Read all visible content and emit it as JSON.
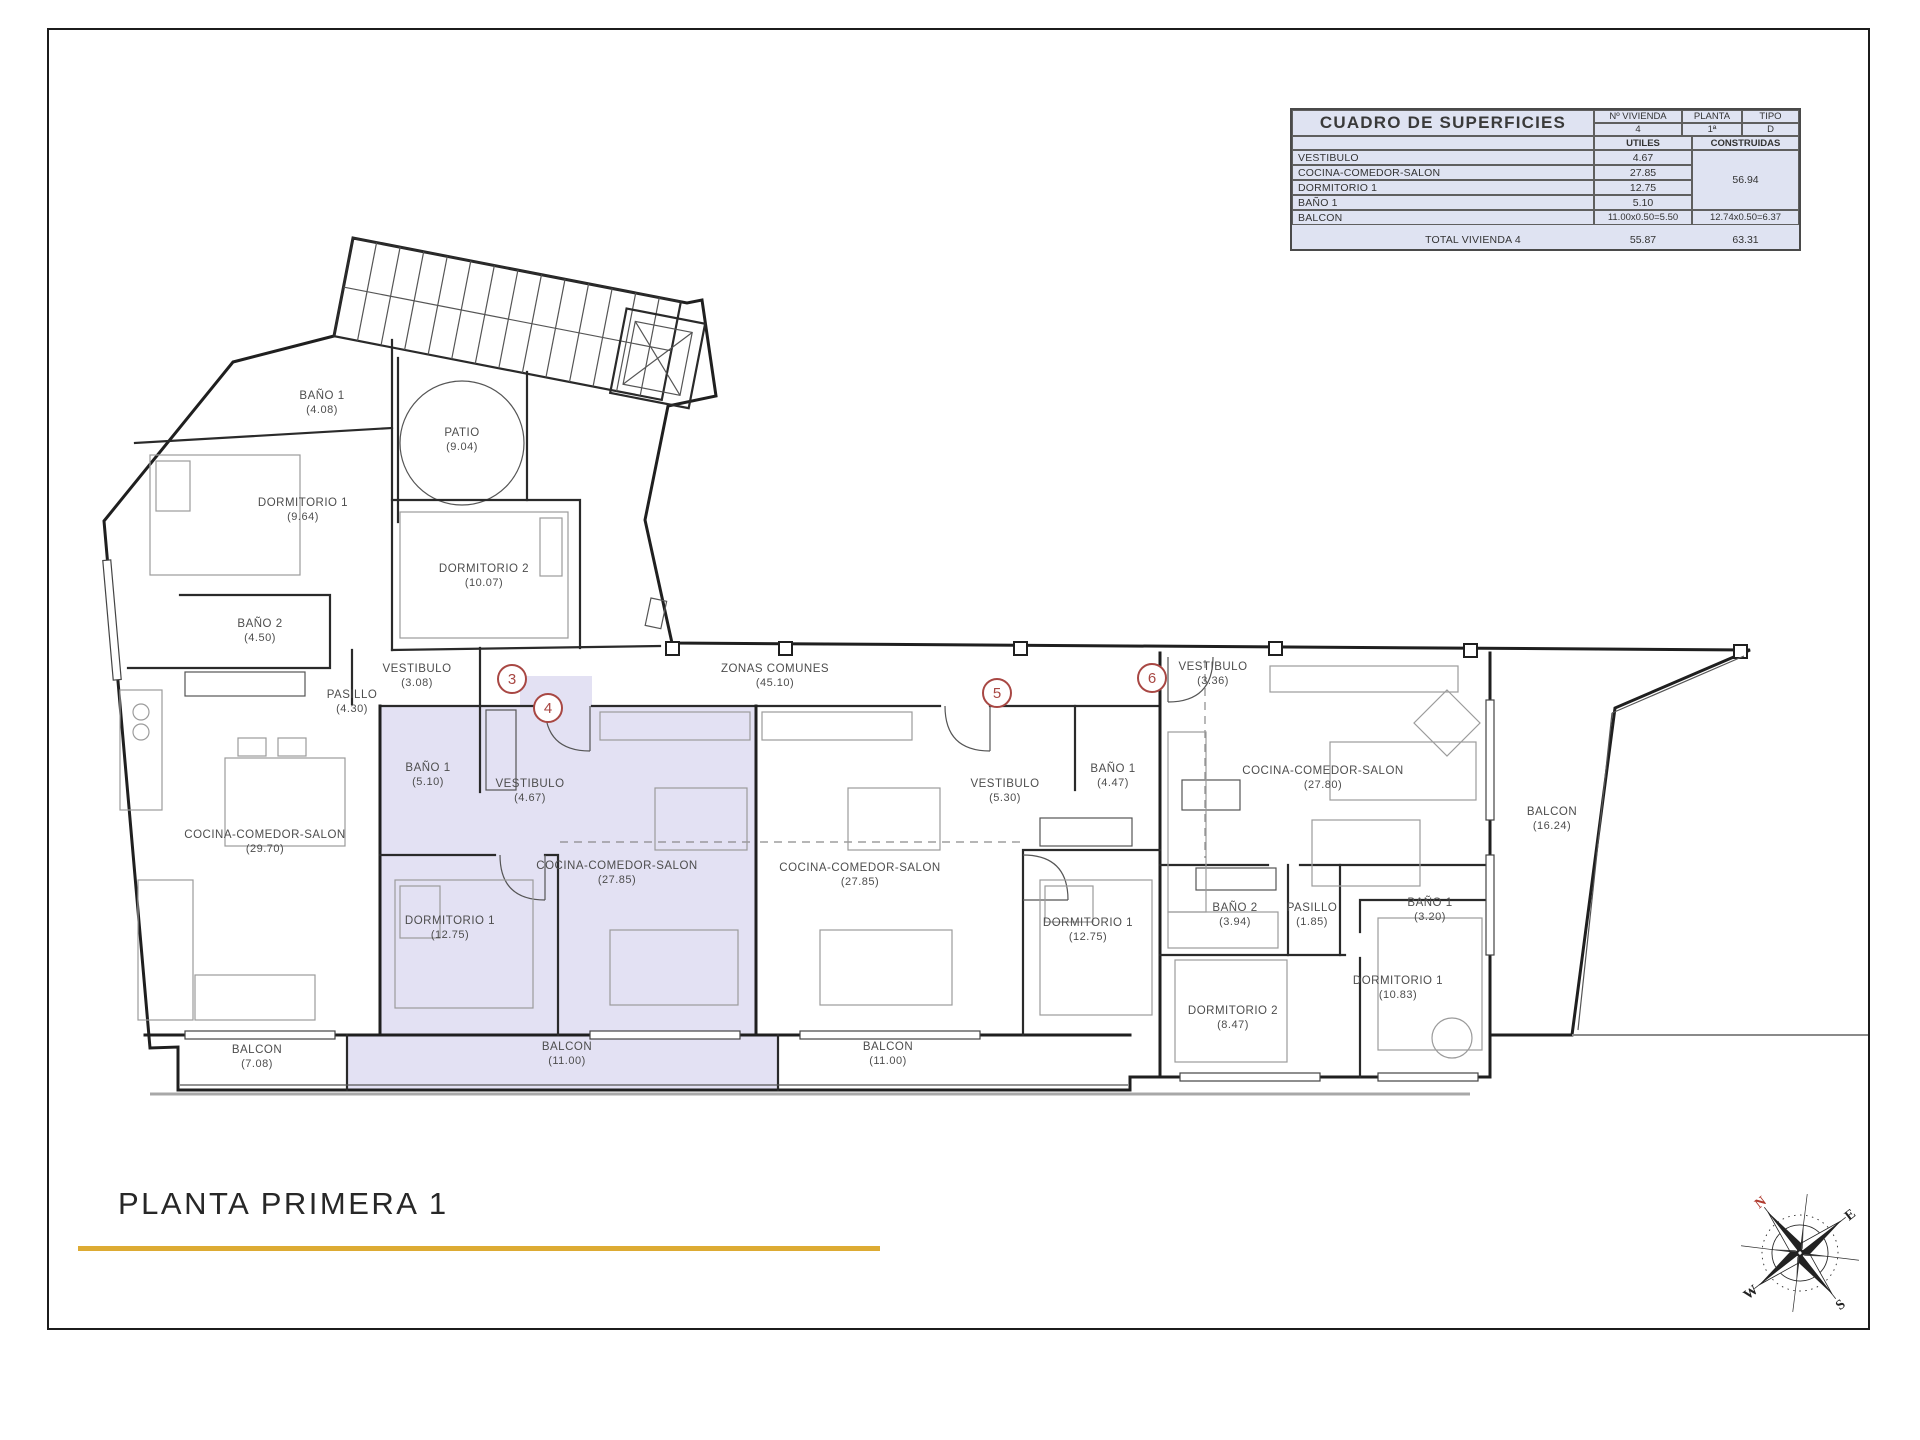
{
  "table": {
    "title": "CUADRO DE SUPERFICIES",
    "col_vivienda": "Nº VIVIENDA",
    "col_planta": "PLANTA",
    "col_tipo": "TIPO",
    "vivienda": "4",
    "planta": "1ª",
    "tipo": "D",
    "utiles_label": "UTILES",
    "construidas_label": "CONSTRUIDAS",
    "rows": [
      {
        "name": "VESTIBULO",
        "utiles": "4.67"
      },
      {
        "name": "COCINA-COMEDOR-SALON",
        "utiles": "27.85"
      },
      {
        "name": "DORMITORIO 1",
        "utiles": "12.75"
      },
      {
        "name": "BAÑO 1",
        "utiles": "5.10"
      }
    ],
    "construidas_merged": "56.94",
    "balcon_row": {
      "name": "BALCON",
      "utiles": "11.00x0.50=5.50",
      "construidas": "12.74x0.50=6.37"
    },
    "total_label": "TOTAL VIVIENDA 4",
    "total_utiles": "55.87",
    "total_construidas": "63.31"
  },
  "plan": {
    "units": [
      {
        "number": "3"
      },
      {
        "number": "4"
      },
      {
        "number": "5"
      },
      {
        "number": "6"
      }
    ],
    "rooms": [
      {
        "name": "BAÑO 1",
        "area": "(4.08)"
      },
      {
        "name": "PATIO",
        "area": "(9.04)"
      },
      {
        "name": "DORMITORIO 1",
        "area": "(9.64)"
      },
      {
        "name": "DORMITORIO 2",
        "area": "(10.07)"
      },
      {
        "name": "BAÑO 2",
        "area": "(4.50)"
      },
      {
        "name": "VESTIBULO",
        "area": "(3.08)"
      },
      {
        "name": "PASILLO",
        "area": "(4.30)"
      },
      {
        "name": "COCINA-COMEDOR-SALON",
        "area": "(29.70)"
      },
      {
        "name": "BALCON",
        "area": "(7.08)"
      },
      {
        "name": "ZONAS COMUNES",
        "area": "(45.10)"
      },
      {
        "name": "BAÑO 1",
        "area": "(5.10)"
      },
      {
        "name": "VESTIBULO",
        "area": "(4.67)"
      },
      {
        "name": "COCINA-COMEDOR-SALON",
        "area": "(27.85)"
      },
      {
        "name": "DORMITORIO 1",
        "area": "(12.75)"
      },
      {
        "name": "BALCON",
        "area": "(11.00)"
      },
      {
        "name": "VESTIBULO",
        "area": "(5.30)"
      },
      {
        "name": "BAÑO 1",
        "area": "(4.47)"
      },
      {
        "name": "COCINA-COMEDOR-SALON",
        "area": "(27.85)"
      },
      {
        "name": "DORMITORIO 1",
        "area": "(12.75)"
      },
      {
        "name": "BALCON",
        "area": "(11.00)"
      },
      {
        "name": "VESTIBULO",
        "area": "(3.36)"
      },
      {
        "name": "COCINA-COMEDOR-SALON",
        "area": "(27.80)"
      },
      {
        "name": "BAÑO 2",
        "area": "(3.94)"
      },
      {
        "name": "PASILLO",
        "area": "(1.85)"
      },
      {
        "name": "BAÑO 1",
        "area": "(3.20)"
      },
      {
        "name": "DORMITORIO 2",
        "area": "(8.47)"
      },
      {
        "name": "DORMITORIO 1",
        "area": "(10.83)"
      },
      {
        "name": "BALCON",
        "area": "(16.24)"
      }
    ]
  },
  "footer": {
    "title": "PLANTA PRIMERA 1"
  },
  "compass": {
    "n": "N",
    "e": "E",
    "s": "S",
    "w": "W"
  },
  "colors": {
    "highlight": "#e3e1f3",
    "table_bg": "#dfe3f2",
    "number_red": "#a84743",
    "accent_gold": "#ddab33",
    "wall": "#1f1f1f",
    "label": "#4d4d4d"
  }
}
